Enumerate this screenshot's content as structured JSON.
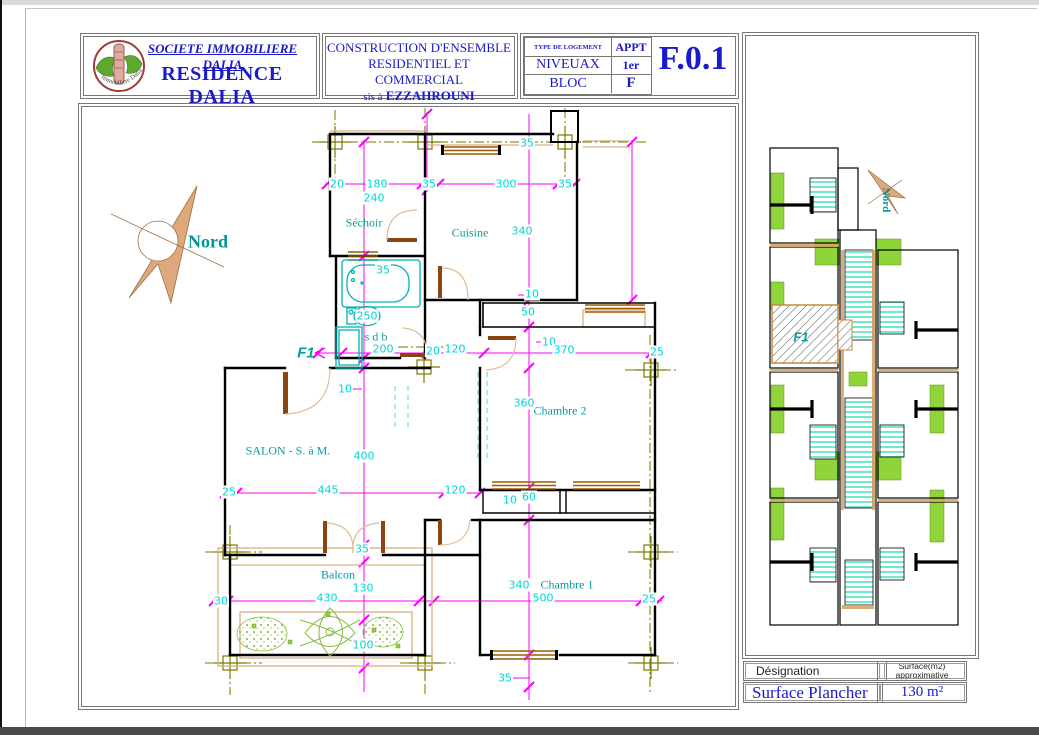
{
  "title_block": {
    "logo_text": "Immobiliere Dalia",
    "company": "SOCIETE  IMMOBILIERE DALIA",
    "residence": "RESIDENCE DALIA",
    "project_line1": "CONSTRUCTION D'ENSEMBLE",
    "project_line2": "RESIDENTIEL ET COMMERCIAL",
    "location_prefix": "sis à",
    "location_name": "EZZAHROUNI",
    "type_label": "TYPE DE LOGEMENT",
    "type_value": "APPT",
    "level_label": "NIVEUAX",
    "level_value": "1er",
    "block_label": "BLOC",
    "block_value": "F",
    "drawing_number": "F.0.1"
  },
  "plan": {
    "north_label": "Nord",
    "unit_label": "F1",
    "rooms": [
      "Séchoir",
      "Cuisine",
      "s d b",
      "SALON - S. à M.",
      "Chambre 2",
      "Chambre 1",
      "Balcon"
    ],
    "dims": [
      "20",
      "180",
      "240",
      "35",
      "300",
      "35",
      "35",
      "340",
      "35",
      "250",
      "200",
      "20",
      "120",
      "10",
      "50",
      "10",
      "370",
      "25",
      "10",
      "360",
      "400",
      "25",
      "445",
      "120",
      "10",
      "60",
      "35",
      "130",
      "30",
      "430",
      "340",
      "500",
      "25",
      "100",
      "35"
    ]
  },
  "key_plan": {
    "north_label": "Nord",
    "unit_label": "F1"
  },
  "surface_table": {
    "designation_label": "Désignation",
    "surface_label_line1": "Surface(m2)",
    "surface_label_line2": "approximative",
    "designation_value": "Surface  Plancher",
    "surface_value": "130 m²"
  },
  "colors": {
    "blue": "#1A1ACB",
    "cyan_dim": "#00D5D5",
    "teal_room": "#0B9B9B",
    "magenta": "#FF00FF",
    "olive": "#7A7A00",
    "green": "#8FD438",
    "tan": "#DDAF7E"
  }
}
